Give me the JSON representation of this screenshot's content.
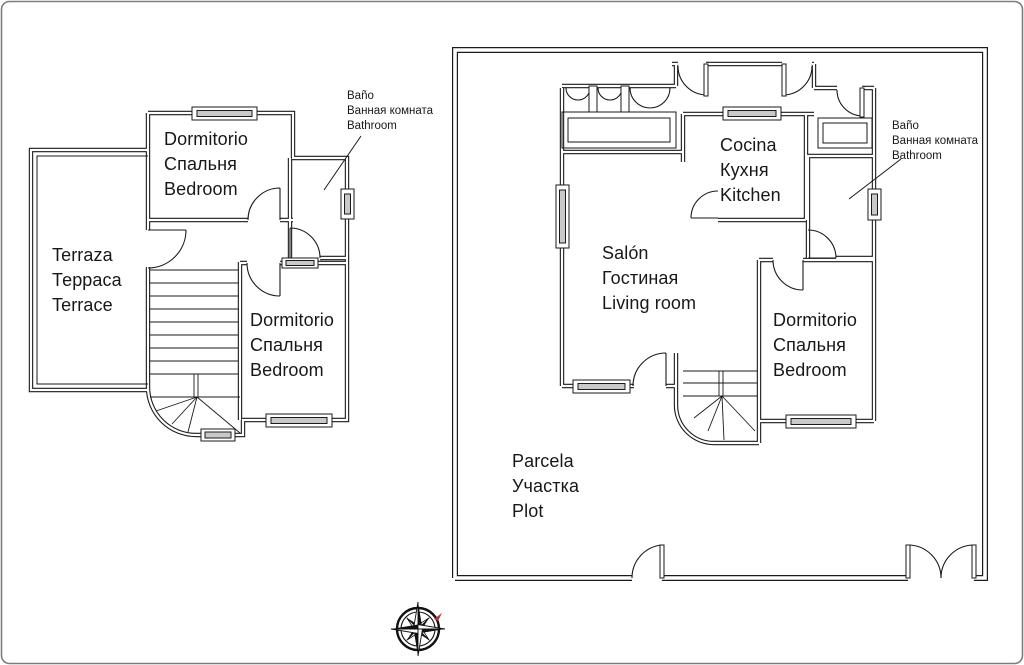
{
  "drawing": {
    "type": "floor-plan",
    "colors": {
      "background": "#ffffff",
      "wall_line": "#1a1a1a",
      "window_fill": "#c9c9c9",
      "border": "#7d7d7d",
      "north_mark": "#c03030"
    }
  },
  "upper_floor": {
    "bedroom_top": {
      "lines": [
        "Dormitorio",
        "Спальня",
        "Bedroom"
      ]
    },
    "terrace": {
      "lines": [
        "Terraza",
        "Терраса",
        "Terrace"
      ]
    },
    "bedroom_bottom": {
      "lines": [
        "Dormitorio",
        "Спальня",
        "Bedroom"
      ]
    },
    "bathroom_note": {
      "lines": [
        "Baño",
        "Ванная комната",
        "Bathroom"
      ]
    }
  },
  "ground_floor": {
    "kitchen": {
      "lines": [
        "Cocina",
        "Кухня",
        "Kitchen"
      ]
    },
    "living_room": {
      "lines": [
        "Salón",
        "Гостиная",
        "Living room"
      ]
    },
    "bedroom": {
      "lines": [
        "Dormitorio",
        "Спальня",
        "Bedroom"
      ]
    },
    "bathroom_note": {
      "lines": [
        "Baño",
        "Ванная комната",
        "Bathroom"
      ]
    },
    "plot": {
      "lines": [
        "Parcela",
        "Участка",
        "Plot"
      ]
    }
  },
  "compass": {
    "name": "compass-rose",
    "north_mark_color": "#c03030"
  }
}
